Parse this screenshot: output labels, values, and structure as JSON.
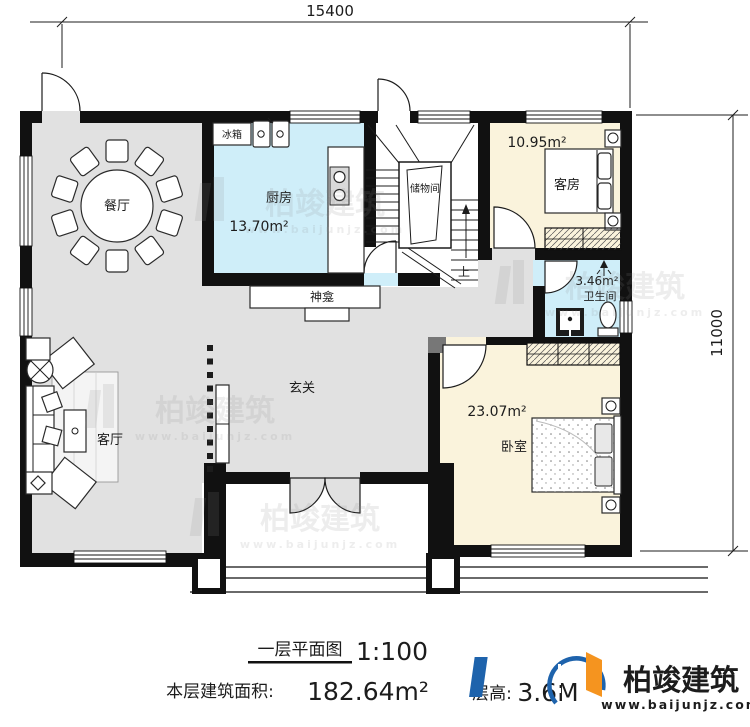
{
  "meta": {
    "plan_title": "一层平面图",
    "scale": "1:100",
    "area_label": "本层建筑面积:",
    "area_value": "182.64m²",
    "floor_height_label": "层高:",
    "floor_height_value": "3.6M"
  },
  "dimensions": {
    "width_mm": "15400",
    "height_mm": "11000"
  },
  "rooms": {
    "dining": {
      "name": "餐厅"
    },
    "kitchen": {
      "name": "厨房",
      "area": "13.70m²"
    },
    "fridge_label": "冰箱",
    "storage": {
      "name": "储物间"
    },
    "stairs_up_label": "上",
    "guest": {
      "name": "客房",
      "area": "10.95m²"
    },
    "bathroom": {
      "name": "卫生间",
      "area": "3.46m²"
    },
    "shrine_label": "神龛",
    "hall": {
      "name": "玄关"
    },
    "living": {
      "name": "客厅"
    },
    "bedroom": {
      "name": "卧室",
      "area": "23.07m²"
    }
  },
  "branding": {
    "company": "柏竣建筑",
    "website": "www.baijunjz.com"
  },
  "watermark": {
    "text": "柏竣建筑",
    "subtext": "www.baijunjz.com"
  },
  "colors": {
    "wall": "#111111",
    "floor_gray": "#e1e1e1",
    "floor_wet": "#cfeef9",
    "floor_warm": "#faf3dc",
    "logo_blue": "#1e63ac",
    "logo_orange": "#f5941f"
  }
}
